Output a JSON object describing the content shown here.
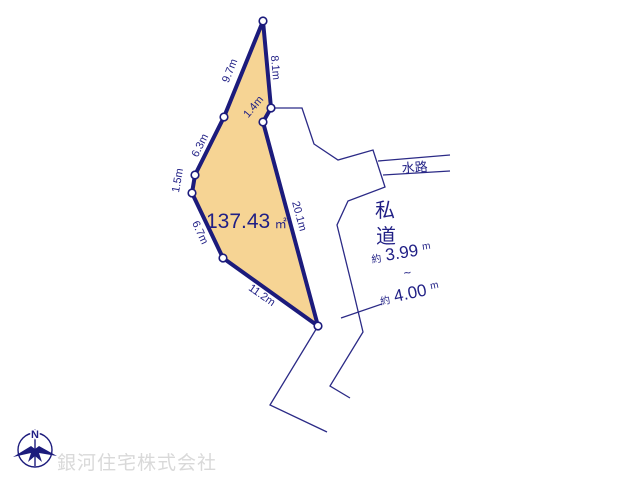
{
  "colors": {
    "parcel_fill": "#F6D494",
    "line_navy": "#1C1B7C",
    "text_navy": "#201F85",
    "watermark_gray": "#D9D9D9"
  },
  "parcel": {
    "area_value": "137.43",
    "area_unit": "㎡",
    "edges": [
      {
        "label": "9.7m"
      },
      {
        "label": "8.1m"
      },
      {
        "label": "1.4m"
      },
      {
        "label": "20.1m"
      },
      {
        "label": "11.2m"
      },
      {
        "label": "6.7m"
      },
      {
        "label": "1.5m"
      },
      {
        "label": "6.3m"
      }
    ]
  },
  "waterway": {
    "label": "水路"
  },
  "private_road": {
    "label_char_1": "私",
    "label_char_2": "道",
    "width_min_prefix": "約",
    "width_min_value": "3.99",
    "width_min_unit": "m",
    "range_tilde": "~",
    "width_max_prefix": "約",
    "width_max_value": "4.00",
    "width_max_unit": "m"
  },
  "compass": {
    "north_label": "N"
  },
  "watermark": {
    "company_name": "銀河住宅株式会社"
  }
}
